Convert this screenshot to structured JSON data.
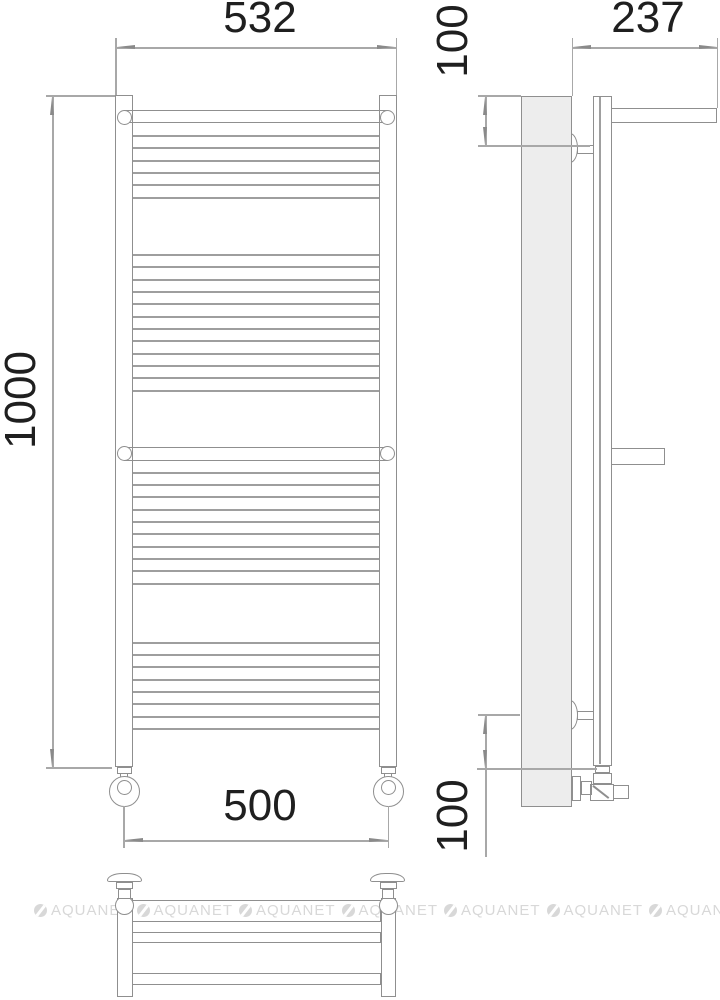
{
  "drawing": {
    "dimensions": {
      "front_width_top": "532",
      "front_height": "1000",
      "front_width_bottom": "500",
      "side_shelf_depth": "237",
      "side_top_offset": "100",
      "side_bottom_offset": "100"
    },
    "front_view": {
      "rung_groups": [
        {
          "start_y": 135.0,
          "count": 6,
          "step": 12.33
        },
        {
          "start_y": 254.0,
          "count": 12,
          "step": 12.33
        },
        {
          "start_y": 471.7,
          "count": 10,
          "step": 12.33
        },
        {
          "start_y": 641.7,
          "count": 8,
          "step": 12.33
        }
      ]
    },
    "watermark": {
      "text": "AQUANET",
      "instances": 7,
      "start_x": 34,
      "spacing": 102.5,
      "y": 903,
      "color": "#d8d8d8"
    },
    "colors": {
      "outline": "#8f8f8f",
      "dim_line": "#a8a8a8",
      "text": "#1f1f1f",
      "panel_fill": "#ededed",
      "background": "#ffffff"
    }
  }
}
